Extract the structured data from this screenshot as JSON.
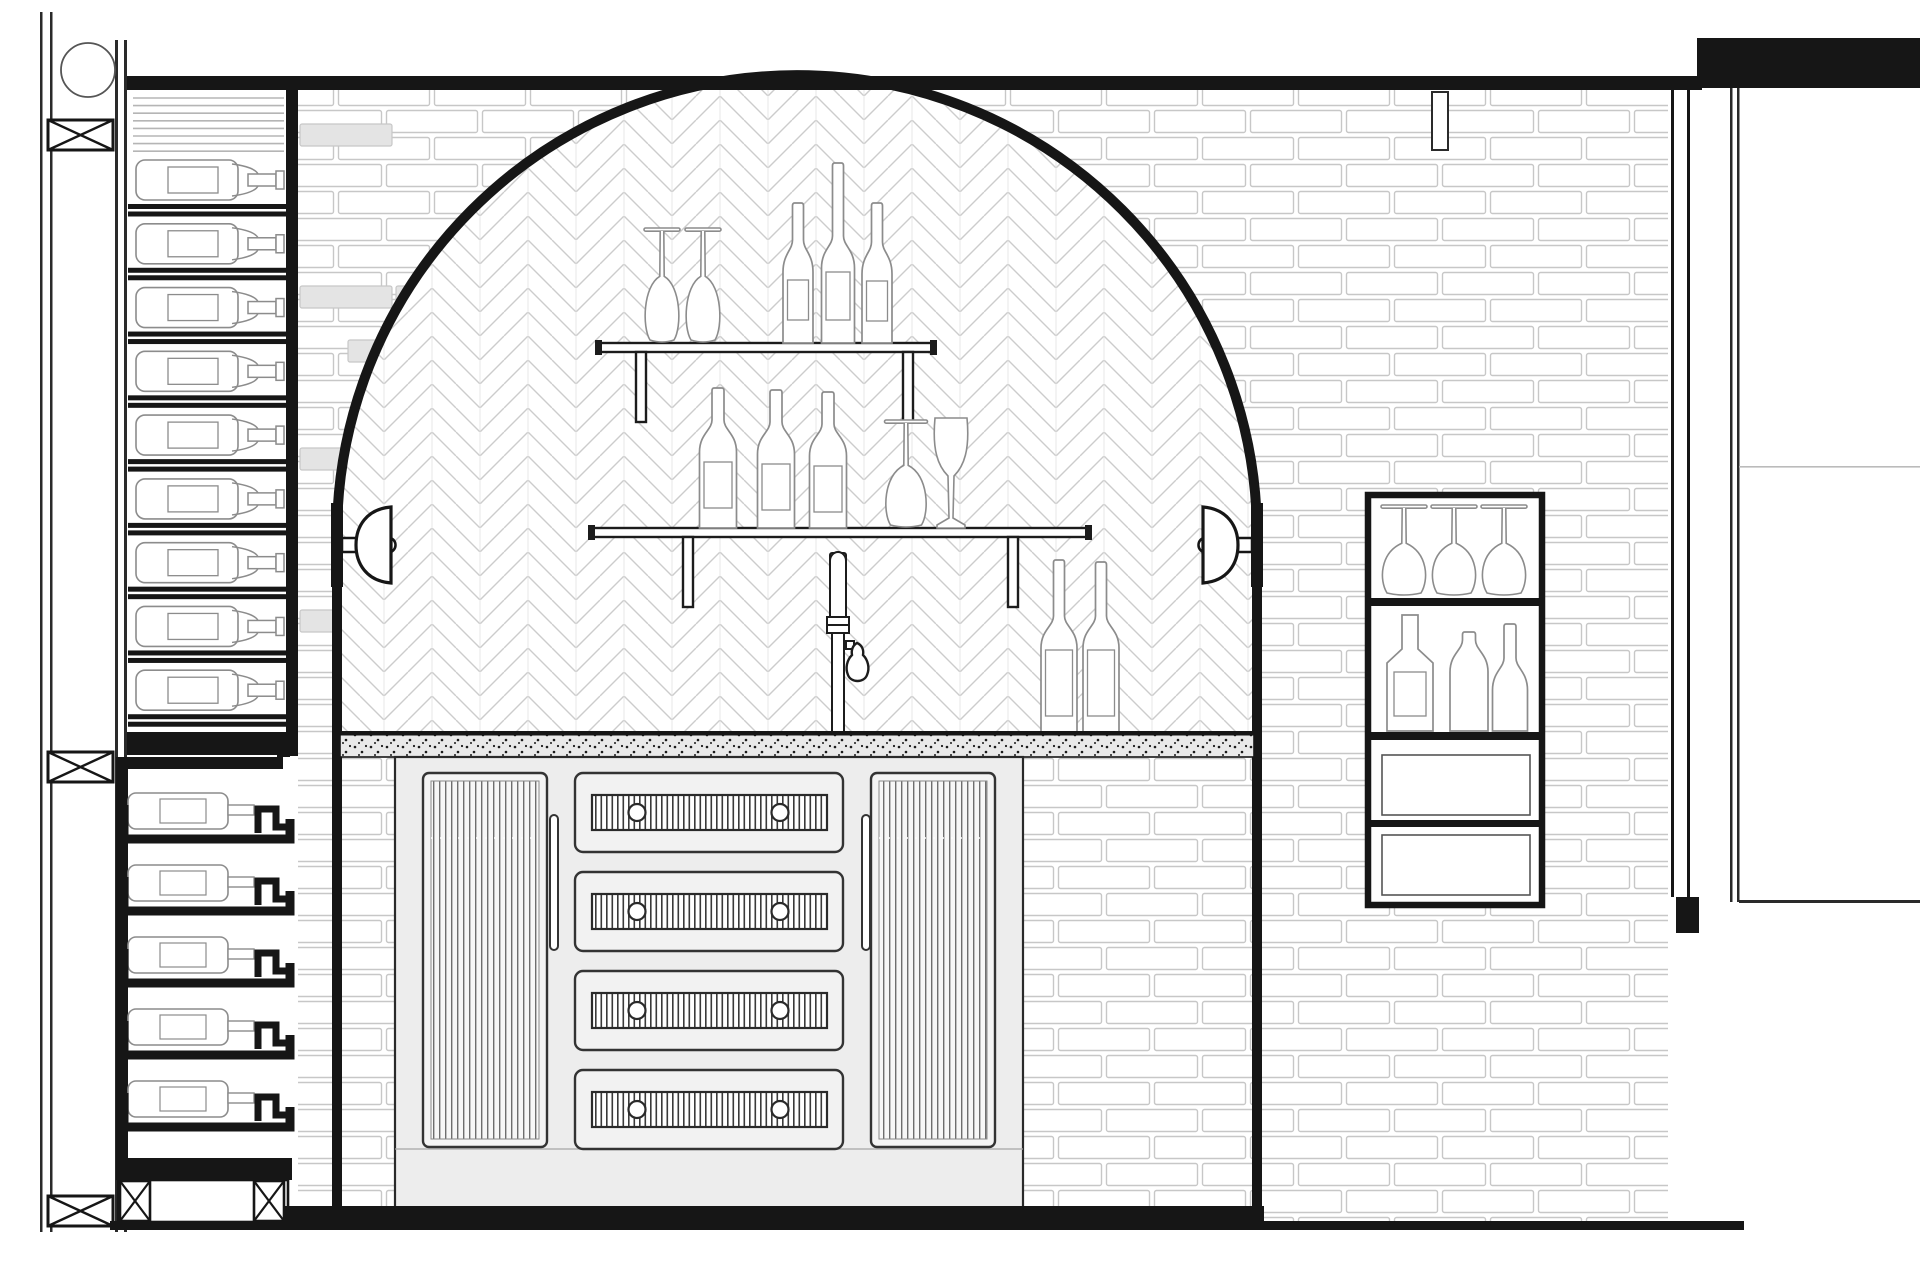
{
  "drawing": {
    "title": "bar-wall-elevation",
    "kind": "architectural line drawing, no text"
  },
  "colors": {
    "ink": "#161616",
    "soft_line": "#8c8c8c",
    "brick_line": "#c7c7c7",
    "brick_shade": "#e4e4e4",
    "tile_line": "#cccccc",
    "cabinet_fill": "#ededed",
    "panel_fill": "#f4f4f4",
    "counter_fill": "#e9e9e9",
    "white": "#ffffff"
  },
  "left_wall": {
    "pipe_circle": true,
    "blocking_count": 3
  },
  "upper_wine_rack": {
    "bottle_slots": 9,
    "vent_line_count": 8
  },
  "lower_wine_rack": {
    "bottle_trays": 5,
    "base_x_braces": 2
  },
  "arch_alcove": {
    "tile": "herringbone",
    "sconces": [
      "sconce-left",
      "sconce-right"
    ]
  },
  "upper_shelf": {
    "items": [
      "wine-glass-inverted",
      "wine-glass-inverted",
      "wine-bottle",
      "wine-bottle-tall",
      "wine-bottle"
    ]
  },
  "lower_shelf": {
    "items": [
      "wine-bottle",
      "wine-bottle",
      "wine-bottle",
      "wine-glass-inverted",
      "wine-glass-upright"
    ]
  },
  "counter": {
    "texture": "stipple",
    "standing_bottles": 2,
    "beer_tap": true
  },
  "bar_cabinet": {
    "reeded_doors": 2,
    "door_handles": 2,
    "drawers": 4,
    "knobs_per_drawer": 2
  },
  "right_display_cabinet": {
    "inverted_glasses": 3,
    "bottles": 3,
    "blank_panels": 2
  },
  "wall": {
    "brick": "subway",
    "right_trim": true,
    "hanging_tab": true
  },
  "adjacent_structure": {
    "top_bar": true,
    "edge_line": true,
    "counter_line": true
  }
}
